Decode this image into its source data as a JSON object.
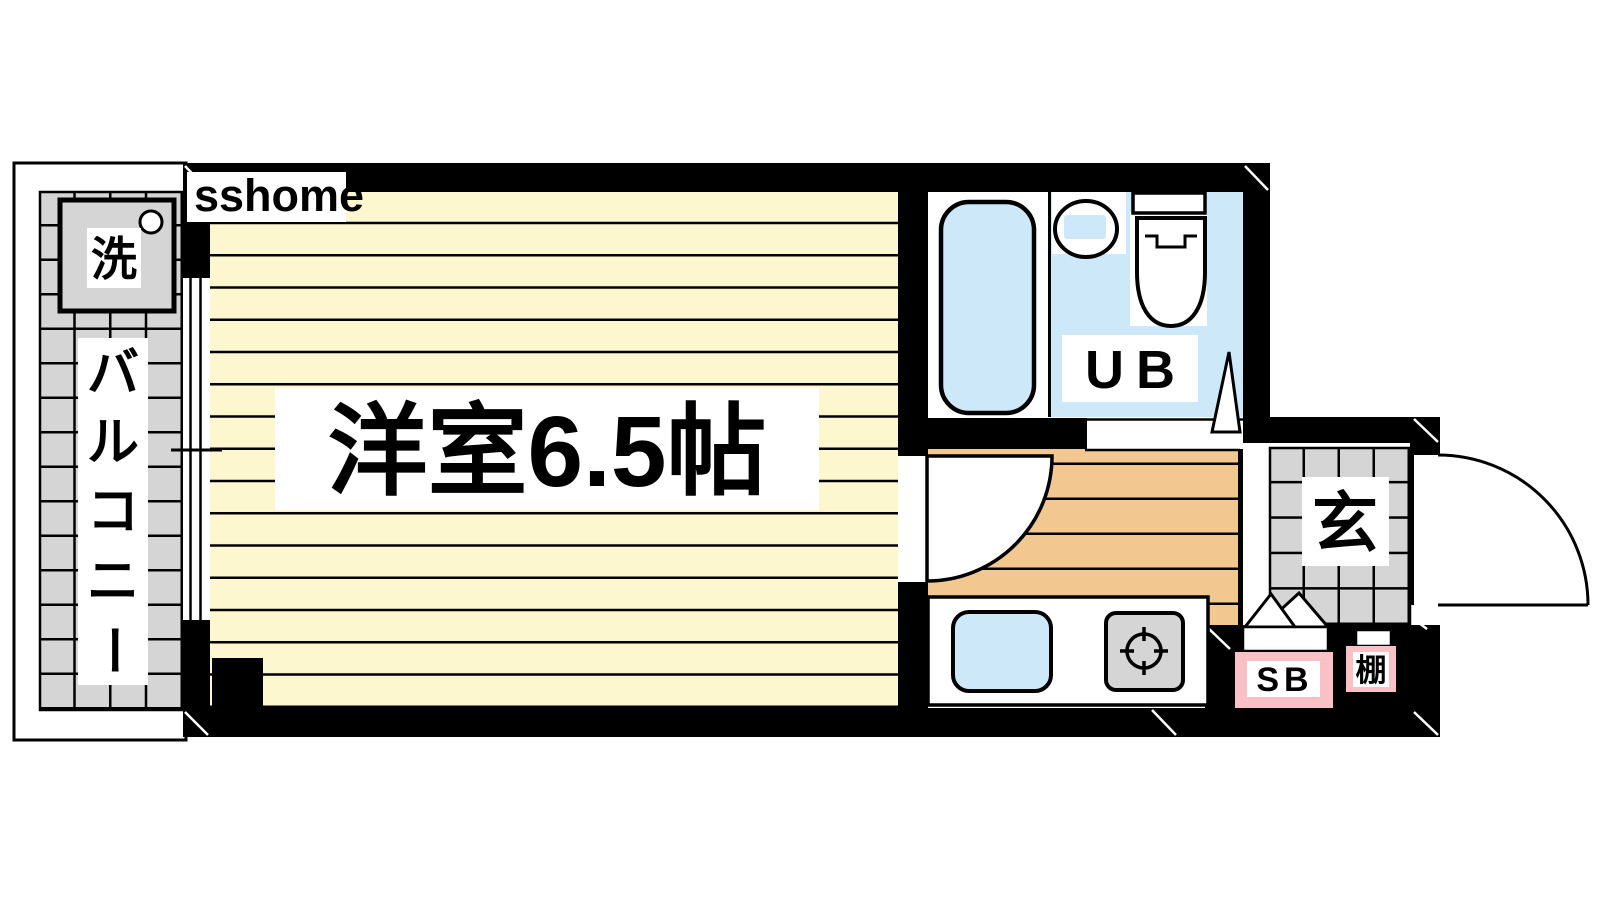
{
  "watermark": {
    "label": "sshome"
  },
  "rooms": {
    "main_room": {
      "label": "洋室6.5帖"
    },
    "balcony": {
      "label": "バルコニー",
      "chars": [
        "バ",
        "ル",
        "コ",
        "ニ",
        "ー"
      ]
    },
    "washing_machine": {
      "label": "洗"
    },
    "unit_bath": {
      "label": "UB"
    },
    "entrance": {
      "label": "玄"
    },
    "shoe_box": {
      "label": "SB"
    },
    "shelf": {
      "label": "棚"
    }
  },
  "colors": {
    "wall": "#000000",
    "floor_yellow": "#FDF7CF",
    "floor_orange": "#F2C890",
    "water_blue": "#CDE9F9",
    "tile_gray": "#D5D5D5",
    "accent_pink": "#F9C1C6",
    "white": "#FFFFFF",
    "watermark_text": "#161616"
  }
}
